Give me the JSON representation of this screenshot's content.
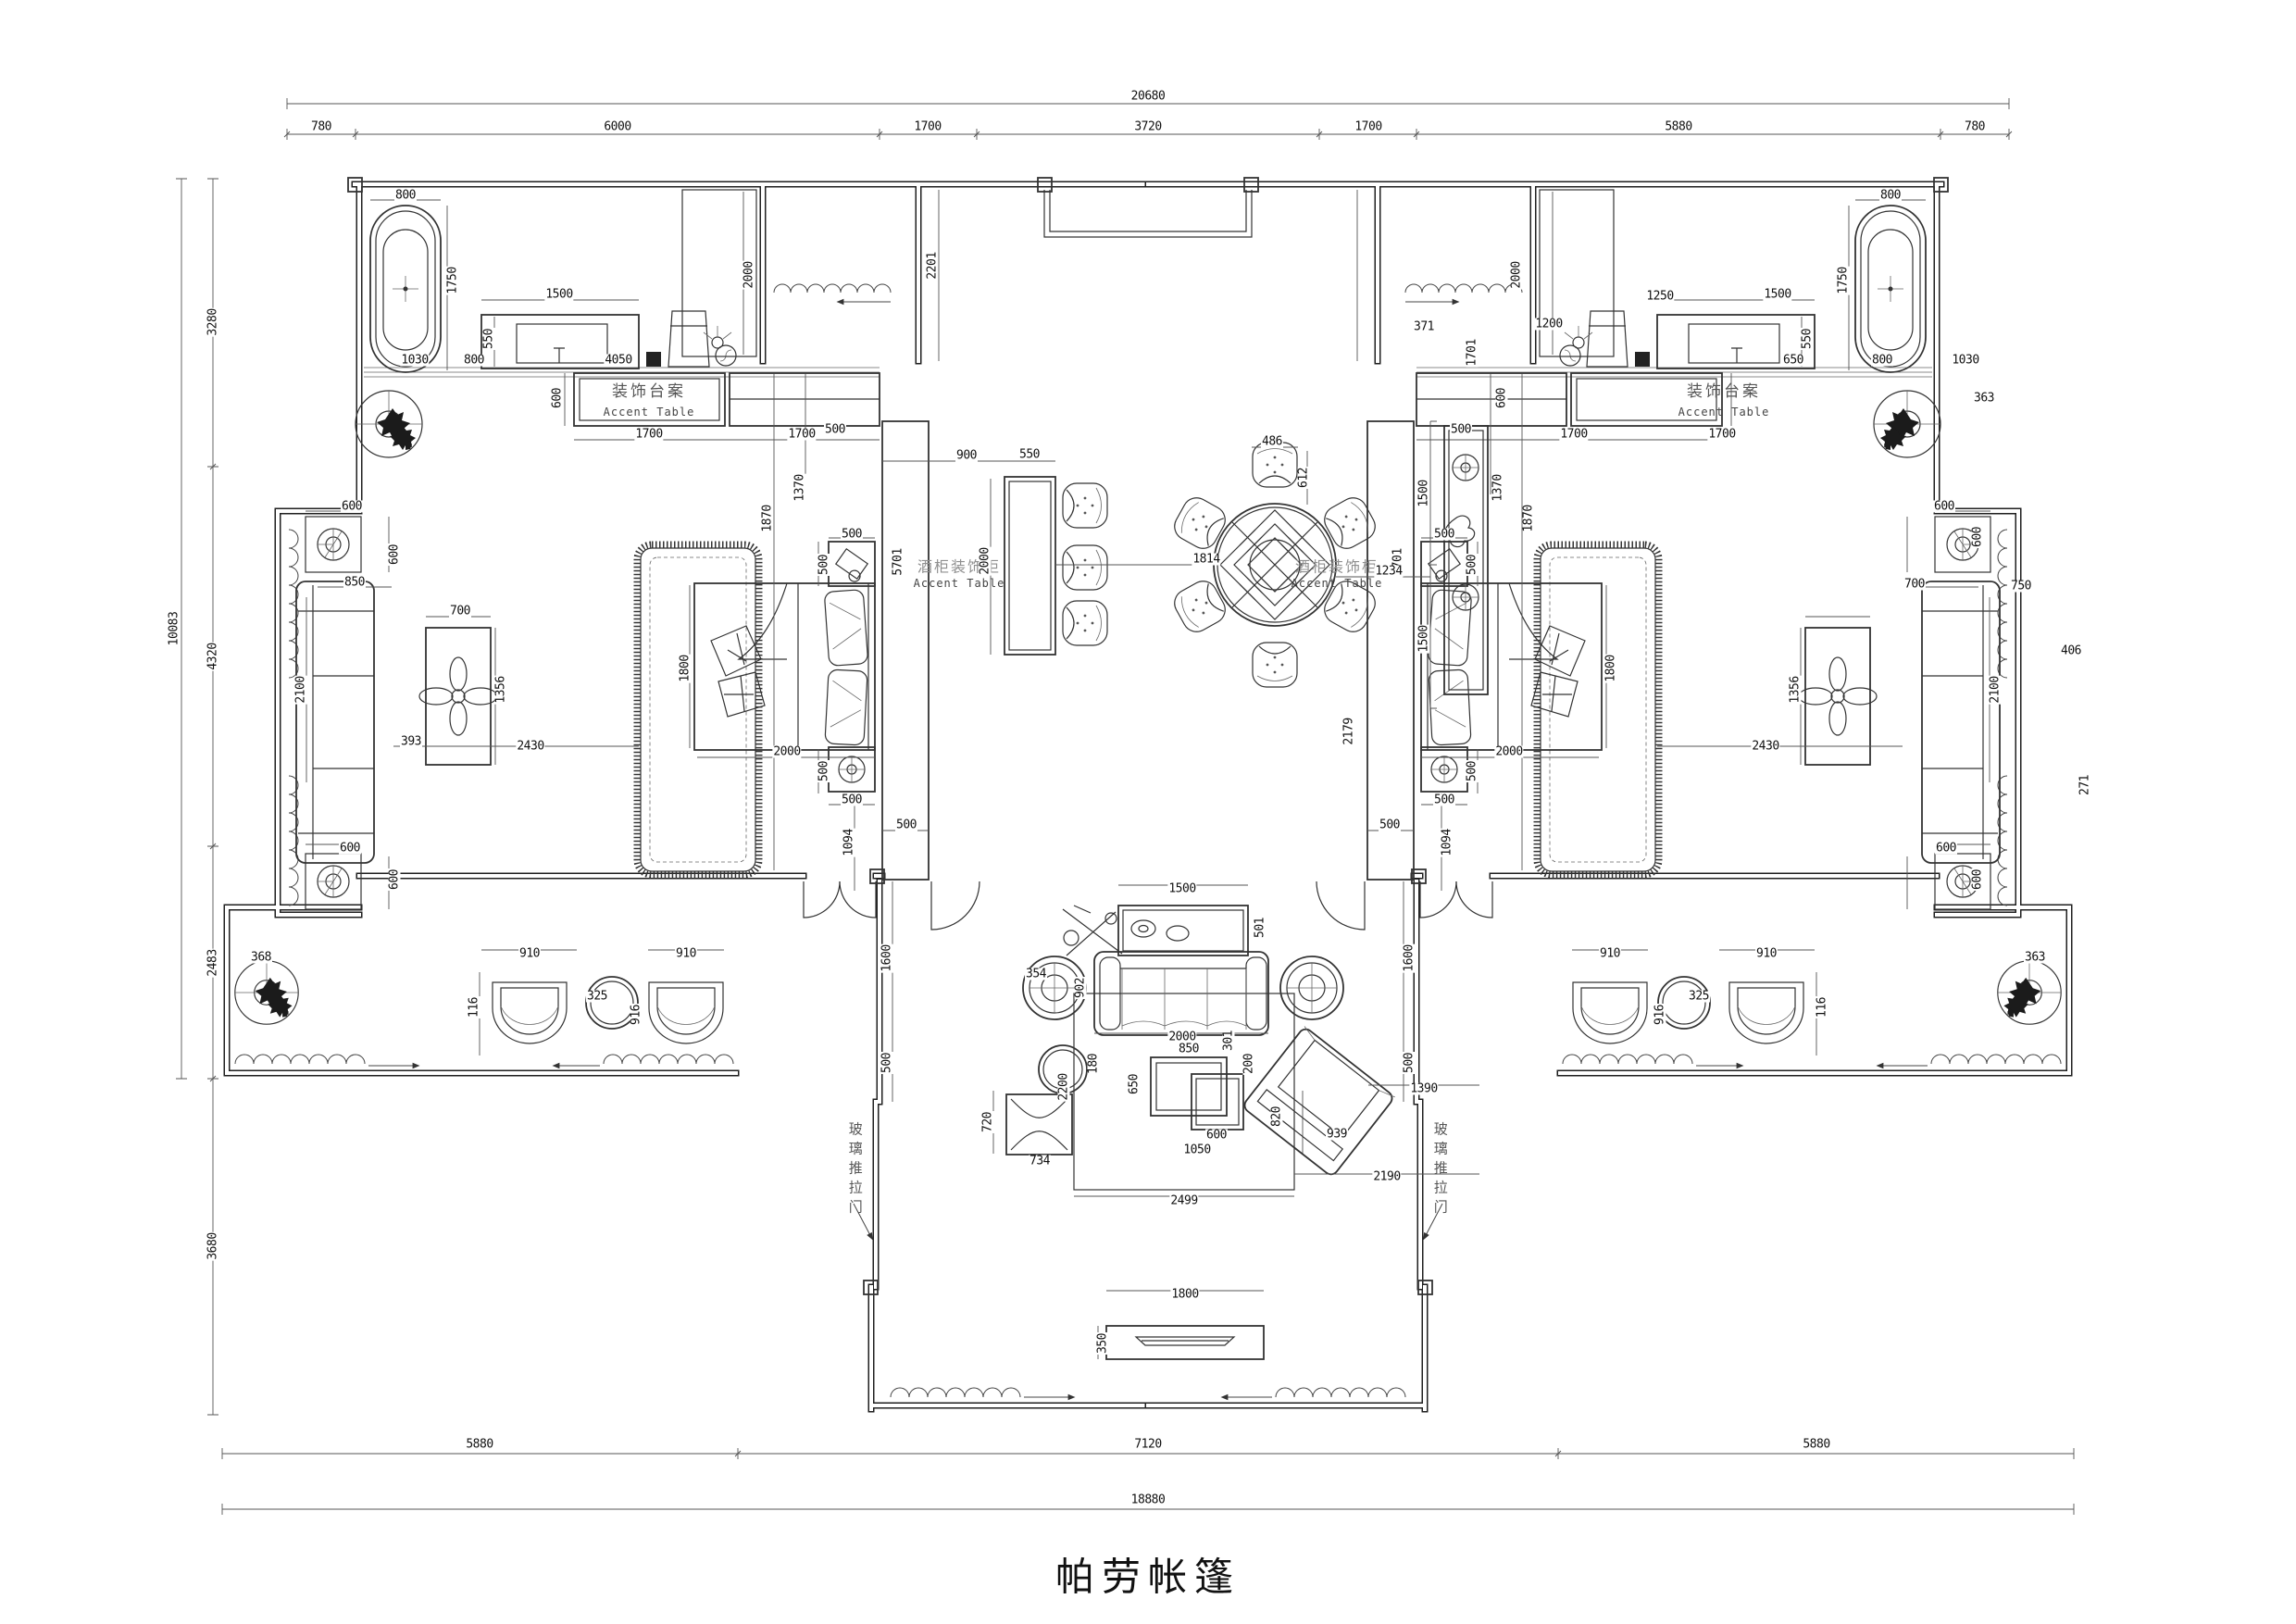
{
  "title": "帕劳帐篷",
  "colors": {
    "line": "#222222",
    "dim_text": "#111111",
    "light_text": "#8f8f8f",
    "paper": "#ffffff"
  },
  "room_labels": {
    "accent_table_cn": "装饰台案",
    "accent_table_en": "Accent Table",
    "wine_cabinet_cn": "酒柜装饰柜",
    "sliding_door_cn": "玻璃推拉门"
  },
  "dimension_chains": {
    "top": [
      "780",
      "6000",
      "1700",
      "3720",
      "1700",
      "5880",
      "780"
    ],
    "top_overall": "20680",
    "left": [
      "3280",
      "4320",
      "2483",
      "3680"
    ],
    "left_overall": "10083",
    "bottom": [
      "5880",
      "7120",
      "5880"
    ],
    "bottom_overall": "18880"
  },
  "labels": [
    [
      "20680",
      1240,
      104,
      ""
    ],
    [
      "780",
      347,
      137,
      ""
    ],
    [
      "6000",
      667,
      137,
      ""
    ],
    [
      "1700",
      1002,
      137,
      ""
    ],
    [
      "3720",
      1240,
      137,
      ""
    ],
    [
      "1700",
      1478,
      137,
      ""
    ],
    [
      "5880",
      1813,
      137,
      ""
    ],
    [
      "780",
      2133,
      137,
      ""
    ],
    [
      "3280",
      230,
      348,
      "v"
    ],
    [
      "10083",
      188,
      679,
      "v"
    ],
    [
      "4320",
      230,
      709,
      "v"
    ],
    [
      "2483",
      230,
      1040,
      "v"
    ],
    [
      "3680",
      230,
      1346,
      "v"
    ],
    [
      "5880",
      518,
      1560,
      ""
    ],
    [
      "7120",
      1240,
      1560,
      ""
    ],
    [
      "5880",
      1962,
      1560,
      ""
    ],
    [
      "18880",
      1240,
      1620,
      ""
    ],
    [
      "800",
      438,
      211,
      ""
    ],
    [
      "1750",
      489,
      303,
      "v"
    ],
    [
      "1500",
      604,
      318,
      ""
    ],
    [
      "550",
      528,
      366,
      "v"
    ],
    [
      "1030",
      448,
      389,
      ""
    ],
    [
      "800",
      512,
      389,
      ""
    ],
    [
      "4050",
      668,
      389,
      ""
    ],
    [
      "2000",
      809,
      297,
      "v"
    ],
    [
      "2201",
      1007,
      287,
      "v"
    ],
    [
      "600",
      602,
      430,
      "v"
    ],
    [
      "装饰台案",
      701,
      423,
      "cn"
    ],
    [
      "Accent Table",
      701,
      445,
      "en"
    ],
    [
      "1700",
      701,
      469,
      ""
    ],
    [
      "1700",
      866,
      469,
      ""
    ],
    [
      "800",
      2042,
      211,
      ""
    ],
    [
      "1750",
      1991,
      303,
      "v"
    ],
    [
      "1500",
      1920,
      318,
      ""
    ],
    [
      "550",
      1952,
      366,
      "v"
    ],
    [
      "650",
      1937,
      389,
      ""
    ],
    [
      "800",
      2033,
      389,
      ""
    ],
    [
      "1030",
      2123,
      389,
      ""
    ],
    [
      "1250",
      1793,
      320,
      ""
    ],
    [
      "1200",
      1673,
      350,
      ""
    ],
    [
      "2000",
      1638,
      297,
      "v"
    ],
    [
      "371",
      1538,
      353,
      ""
    ],
    [
      "1701",
      1590,
      381,
      "v"
    ],
    [
      "363",
      2143,
      430,
      ""
    ],
    [
      "600",
      1622,
      430,
      "v"
    ],
    [
      "装饰台案",
      1862,
      423,
      "cn"
    ],
    [
      "Accent Table",
      1862,
      445,
      "en"
    ],
    [
      "1700",
      1700,
      469,
      ""
    ],
    [
      "1700",
      1860,
      469,
      ""
    ],
    [
      "1870",
      829,
      560,
      "v"
    ],
    [
      "1370",
      864,
      527,
      "v"
    ],
    [
      "500",
      902,
      464,
      ""
    ],
    [
      "500",
      920,
      577,
      ""
    ],
    [
      "500",
      890,
      610,
      "v"
    ],
    [
      "5701",
      970,
      607,
      "v"
    ],
    [
      "酒柜装饰柜",
      1036,
      612,
      "cnl"
    ],
    [
      "Accent Table",
      1036,
      630,
      "en"
    ],
    [
      "1800",
      740,
      722,
      "v"
    ],
    [
      "2000",
      850,
      812,
      ""
    ],
    [
      "500",
      890,
      833,
      "v"
    ],
    [
      "500",
      920,
      864,
      ""
    ],
    [
      "500",
      979,
      891,
      ""
    ],
    [
      "1094",
      917,
      910,
      "v"
    ],
    [
      "900",
      1044,
      492,
      ""
    ],
    [
      "550",
      1112,
      491,
      ""
    ],
    [
      "2000",
      1064,
      606,
      "v"
    ],
    [
      "1600",
      958,
      1035,
      "v"
    ],
    [
      "500",
      958,
      1148,
      "v"
    ],
    [
      "1870",
      1651,
      560,
      "v"
    ],
    [
      "1370",
      1618,
      527,
      "v"
    ],
    [
      "500",
      1578,
      464,
      ""
    ],
    [
      "500",
      1560,
      577,
      ""
    ],
    [
      "500",
      1590,
      610,
      "v"
    ],
    [
      "5701",
      1510,
      607,
      "v"
    ],
    [
      "酒柜装饰柜",
      1444,
      612,
      "cnl"
    ],
    [
      "Accent Table",
      1444,
      630,
      "en"
    ],
    [
      "1800",
      1740,
      722,
      "v"
    ],
    [
      "2000",
      1630,
      812,
      ""
    ],
    [
      "500",
      1590,
      833,
      "v"
    ],
    [
      "500",
      1560,
      864,
      ""
    ],
    [
      "500",
      1501,
      891,
      ""
    ],
    [
      "1094",
      1563,
      910,
      "v"
    ],
    [
      "2179",
      1457,
      790,
      "v"
    ],
    [
      "1500",
      1538,
      533,
      "v"
    ],
    [
      "1500",
      1538,
      690,
      "v"
    ],
    [
      "1600",
      1522,
      1035,
      "v"
    ],
    [
      "500",
      1522,
      1148,
      "v"
    ],
    [
      "486",
      1374,
      477,
      ""
    ],
    [
      "612",
      1408,
      516,
      "v"
    ],
    [
      "1814",
      1303,
      604,
      ""
    ],
    [
      "1234",
      1500,
      617,
      ""
    ],
    [
      "600",
      380,
      547,
      ""
    ],
    [
      "600",
      426,
      599,
      "v"
    ],
    [
      "850",
      383,
      629,
      ""
    ],
    [
      "700",
      497,
      660,
      ""
    ],
    [
      "1356",
      541,
      745,
      "v"
    ],
    [
      "2100",
      325,
      745,
      "v"
    ],
    [
      "393",
      444,
      801,
      ""
    ],
    [
      "2430",
      573,
      806,
      ""
    ],
    [
      "600",
      378,
      916,
      ""
    ],
    [
      "600",
      426,
      950,
      "v"
    ],
    [
      "600",
      2100,
      547,
      ""
    ],
    [
      "600",
      2136,
      580,
      "v"
    ],
    [
      "750",
      2183,
      633,
      ""
    ],
    [
      "700",
      2068,
      631,
      ""
    ],
    [
      "1356",
      1939,
      745,
      "v"
    ],
    [
      "2100",
      2155,
      745,
      "v"
    ],
    [
      "406",
      2237,
      703,
      ""
    ],
    [
      "2430",
      1907,
      806,
      ""
    ],
    [
      "271",
      2252,
      848,
      "v"
    ],
    [
      "600",
      2102,
      916,
      ""
    ],
    [
      "600",
      2136,
      950,
      "v"
    ],
    [
      "368",
      282,
      1034,
      ""
    ],
    [
      "910",
      572,
      1030,
      ""
    ],
    [
      "325",
      645,
      1076,
      ""
    ],
    [
      "916",
      687,
      1096,
      "v"
    ],
    [
      "910",
      741,
      1030,
      ""
    ],
    [
      "116",
      512,
      1088,
      "v"
    ],
    [
      "363",
      2198,
      1034,
      ""
    ],
    [
      "910",
      1908,
      1030,
      ""
    ],
    [
      "325",
      1835,
      1076,
      ""
    ],
    [
      "916",
      1793,
      1096,
      "v"
    ],
    [
      "910",
      1739,
      1030,
      ""
    ],
    [
      "116",
      1968,
      1088,
      "v"
    ],
    [
      "720",
      1067,
      1212,
      "v"
    ],
    [
      "玻璃推拉门",
      924,
      1262,
      "cnv"
    ],
    [
      "玻璃推拉门",
      1556,
      1262,
      "cnv"
    ],
    [
      "1500",
      1277,
      960,
      ""
    ],
    [
      "501",
      1361,
      1002,
      "v"
    ],
    [
      "354",
      1119,
      1052,
      ""
    ],
    [
      "902",
      1167,
      1067,
      "v"
    ],
    [
      "2000",
      1277,
      1120,
      ""
    ],
    [
      "850",
      1284,
      1133,
      ""
    ],
    [
      "301",
      1327,
      1124,
      "v"
    ],
    [
      "200",
      1349,
      1149,
      "v"
    ],
    [
      "180",
      1181,
      1149,
      "v"
    ],
    [
      "650",
      1225,
      1171,
      "v"
    ],
    [
      "2200",
      1149,
      1174,
      "v"
    ],
    [
      "600",
      1314,
      1226,
      ""
    ],
    [
      "1050",
      1293,
      1242,
      ""
    ],
    [
      "820",
      1379,
      1206,
      "v"
    ],
    [
      "939",
      1444,
      1225,
      ""
    ],
    [
      "734",
      1123,
      1254,
      ""
    ],
    [
      "2499",
      1279,
      1297,
      ""
    ],
    [
      "1390",
      1538,
      1176,
      ""
    ],
    [
      "2190",
      1498,
      1271,
      ""
    ],
    [
      "1800",
      1280,
      1398,
      ""
    ],
    [
      "350",
      1191,
      1451,
      "v"
    ]
  ]
}
